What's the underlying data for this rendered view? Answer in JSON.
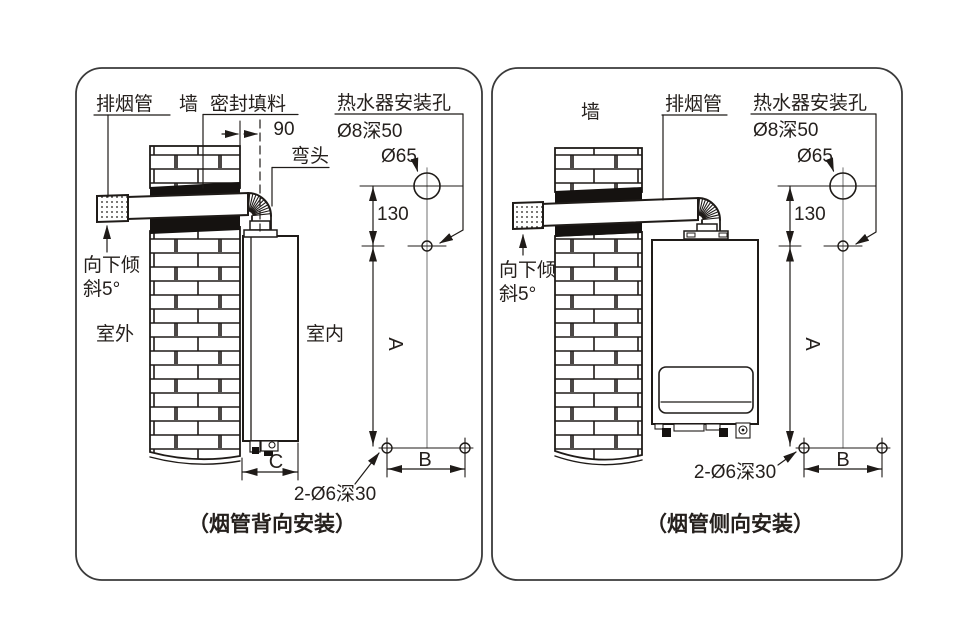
{
  "colors": {
    "line": "#1f1b18",
    "centerline_gray": "#9a9a9a",
    "background": "#ffffff",
    "text": "#25201d",
    "seal_fill": "#151210"
  },
  "left_panel": {
    "caption": "（烟管背向安装）",
    "labels": {
      "exhaust_pipe": "排烟管",
      "wall": "墙",
      "sealing_filler": "密封填料",
      "heater_mount_holes": "热水器安装孔",
      "hole_spec": "Ø8深50",
      "hole_diameter": "Ø65",
      "elbow": "弯头",
      "dim_90": "90",
      "dim_130": "130",
      "tilt_line1": "向下倾",
      "tilt_line2": "斜5°",
      "outdoor": "室外",
      "indoor": "室内",
      "dim_a": "A",
      "dim_b": "B",
      "dim_c": "C",
      "anchor_spec": "2-Ø6深30"
    }
  },
  "right_panel": {
    "caption": "（烟管侧向安装）",
    "labels": {
      "wall": "墙",
      "exhaust_pipe": "排烟管",
      "heater_mount_holes": "热水器安装孔",
      "hole_spec": "Ø8深50",
      "hole_diameter": "Ø65",
      "dim_130": "130",
      "tilt_line1": "向下倾",
      "tilt_line2": "斜5°",
      "dim_a": "A",
      "dim_b": "B",
      "anchor_spec": "2-Ø6深30"
    }
  }
}
